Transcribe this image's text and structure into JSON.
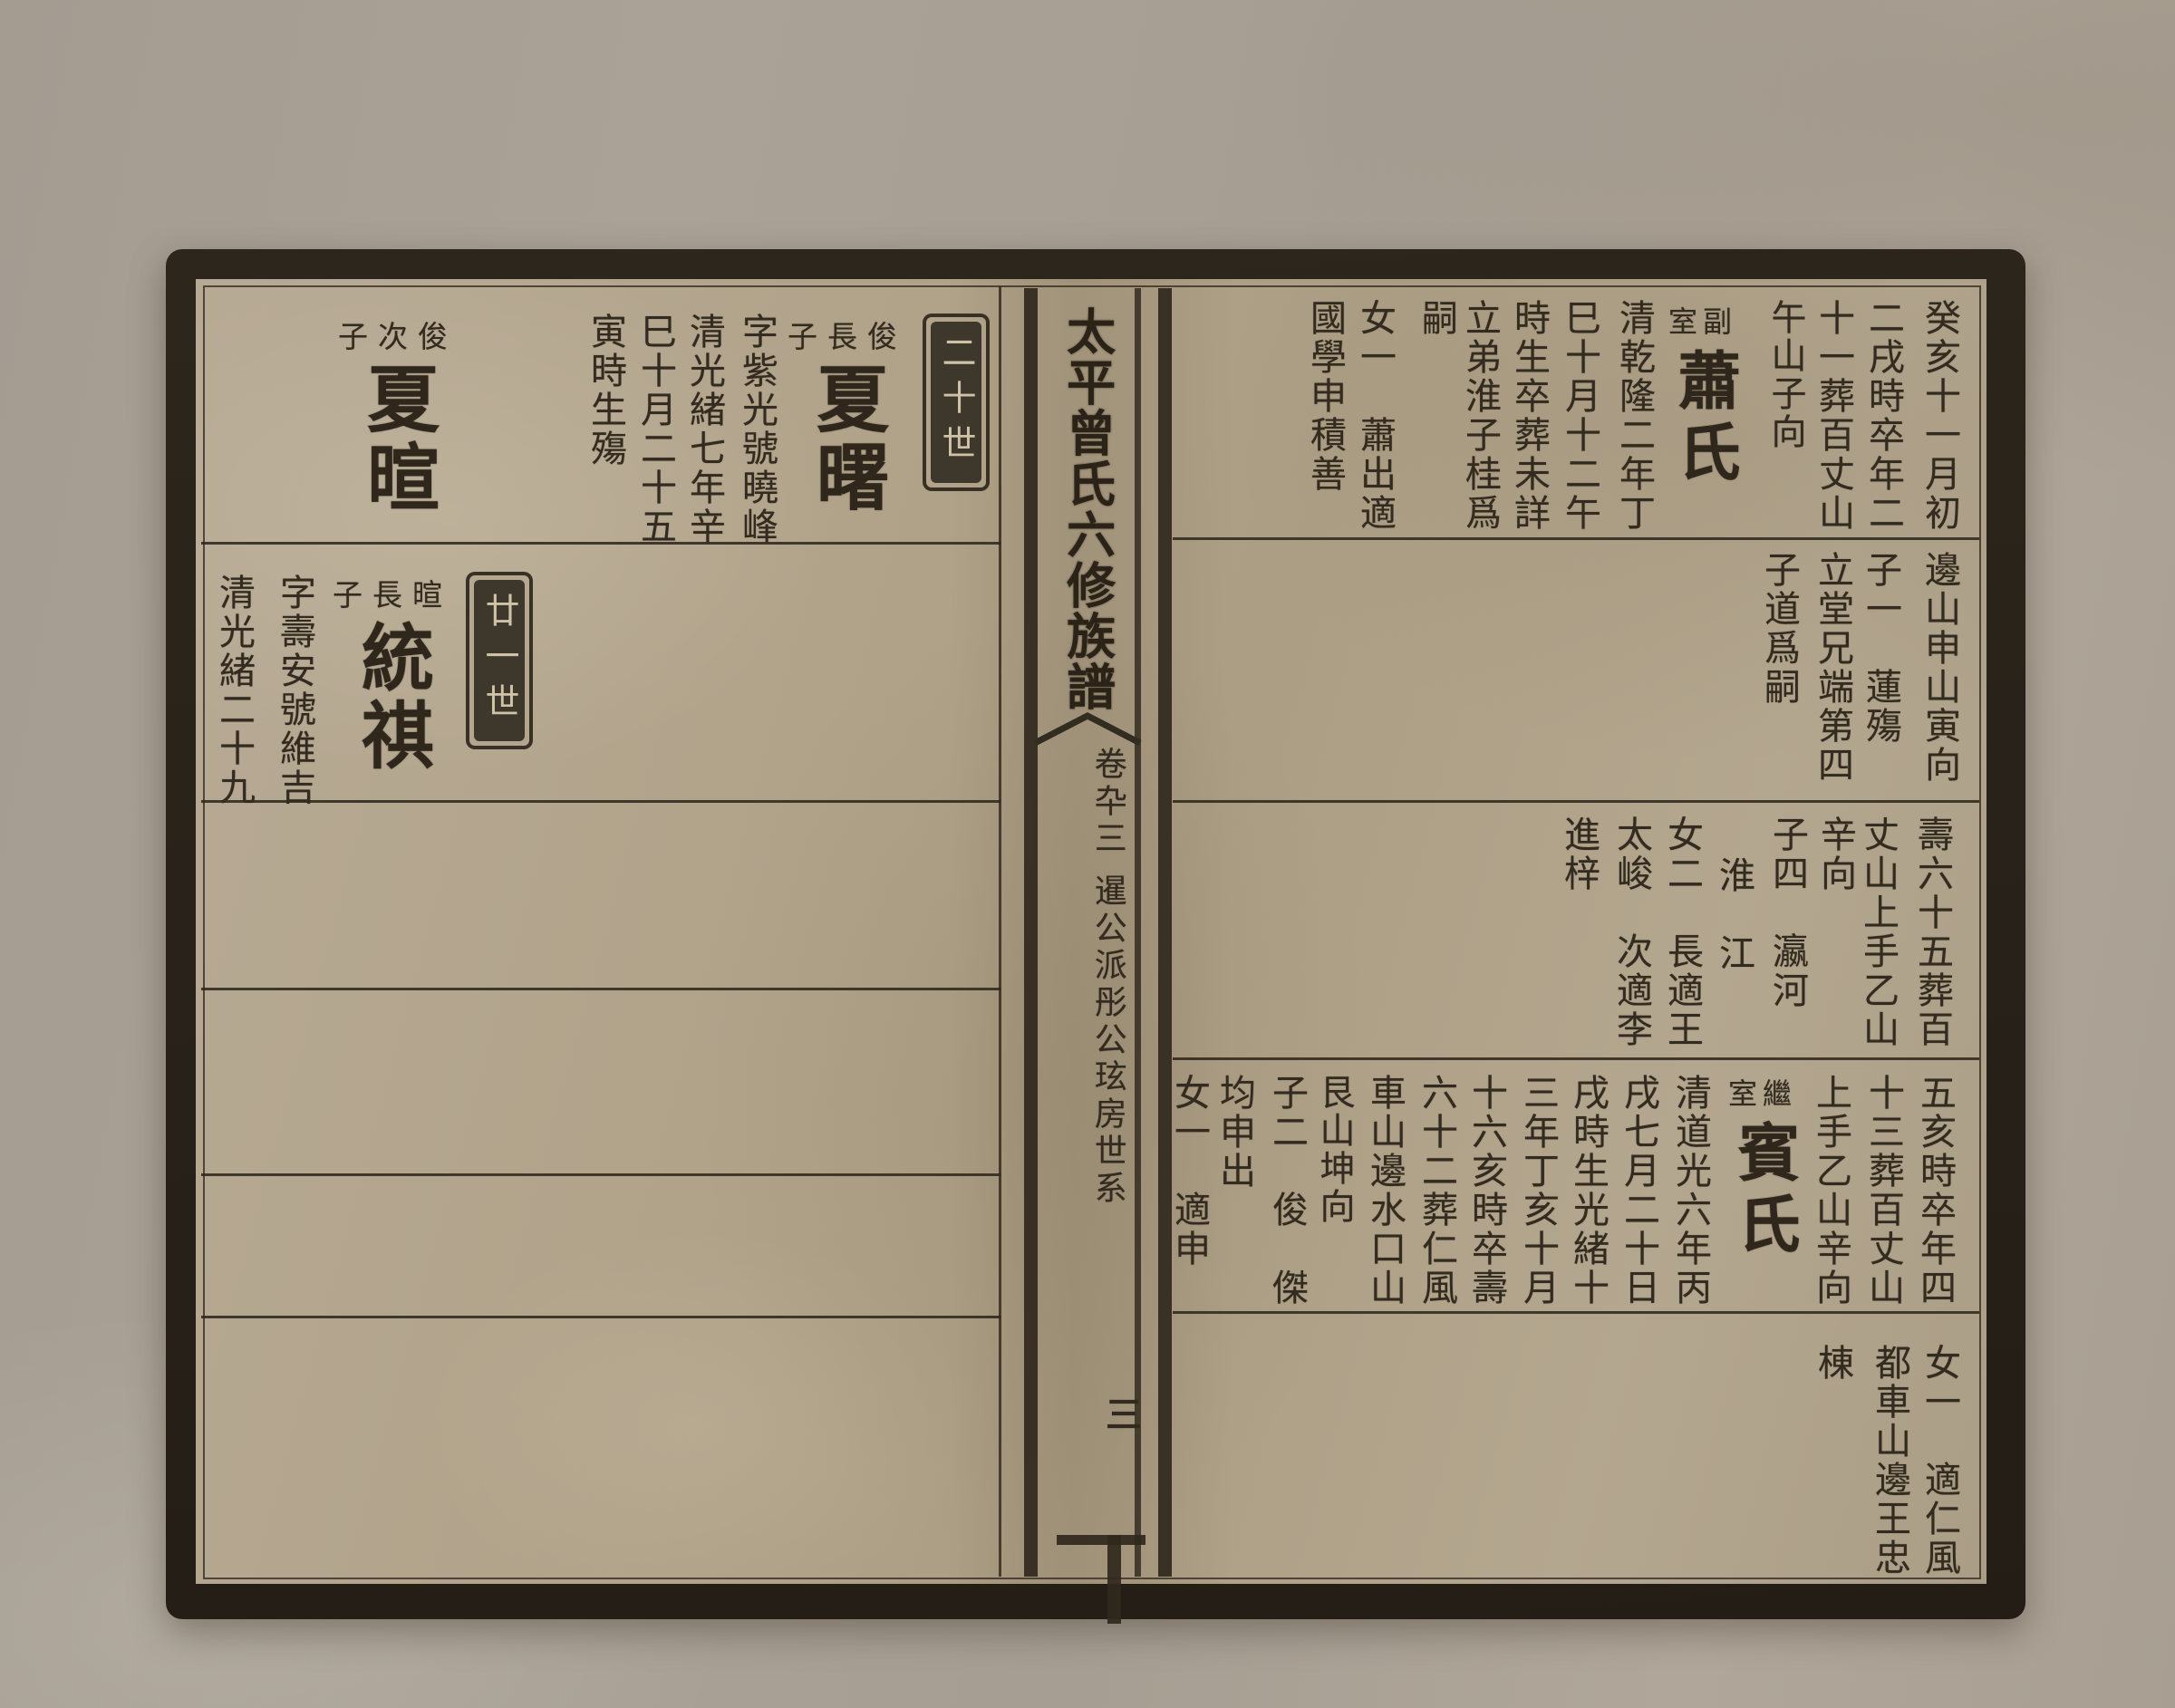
{
  "spine": {
    "title": "太平曾氏六修族譜",
    "volume": "卷卆三",
    "section": "暹公派彤公玹房世系",
    "page_number": "三"
  },
  "left_page": {
    "generation_boxes": [
      {
        "label": "二十世"
      },
      {
        "label": "廿一世"
      }
    ],
    "entries": [
      {
        "relation": "俊長子",
        "name": "夏曙"
      },
      {
        "relation": "俊次子",
        "name": "夏暄"
      },
      {
        "relation": "暄長子",
        "name": "統祺"
      }
    ],
    "rows": [
      {
        "columns": [
          "字紫光號曉峰",
          "清光緒七年辛",
          "巳十月二十五",
          "寅時生殤"
        ]
      },
      {
        "columns": [
          "字壽安號維吉",
          "清光緒二十九"
        ]
      }
    ]
  },
  "right_page": {
    "spouse_entries": [
      {
        "label": "副室",
        "name": "蕭氏"
      },
      {
        "label": "繼室",
        "name": "賓氏"
      }
    ],
    "rows": [
      {
        "columns": [
          "癸亥十一月初",
          "二戌時卒年二",
          "十一葬百丈山",
          "午山子向",
          "清乾隆二年丁",
          "巳十月十二午",
          "時生卒葬未詳",
          "立弟淮子桂爲",
          "嗣",
          "女一　蕭出適",
          "國學申積善"
        ]
      },
      {
        "columns": [
          "邊山申山寅向",
          "子一　蓮殤",
          "立堂兄端第四",
          "子道爲嗣"
        ]
      },
      {
        "columns": [
          "壽六十五葬百",
          "丈山上手乙山",
          "辛向",
          "子四　瀛河",
          "淮　江",
          "女二　長適王",
          "太峻　次適李",
          "進梓"
        ]
      },
      {
        "columns": [
          "五亥時卒年四",
          "十三葬百丈山",
          "上手乙山辛向",
          "清道光六年丙",
          "戌七月二十日",
          "戌時生光緒十",
          "三年丁亥十月",
          "十六亥時卒壽",
          "六十二葬仁風",
          "車山邊水口山",
          "艮山坤向",
          "子二　俊　傑",
          "均申出",
          "女一　適申"
        ]
      },
      {
        "columns": [
          "女一　適仁風",
          "都車山邊王忠",
          "棟"
        ]
      }
    ]
  },
  "colors": {
    "paper": "#b2a48c",
    "ink": "#332b1f",
    "frame": "#28221a",
    "cartouche_fill": "#3e372b",
    "cartouche_text": "#cfc2a6"
  }
}
